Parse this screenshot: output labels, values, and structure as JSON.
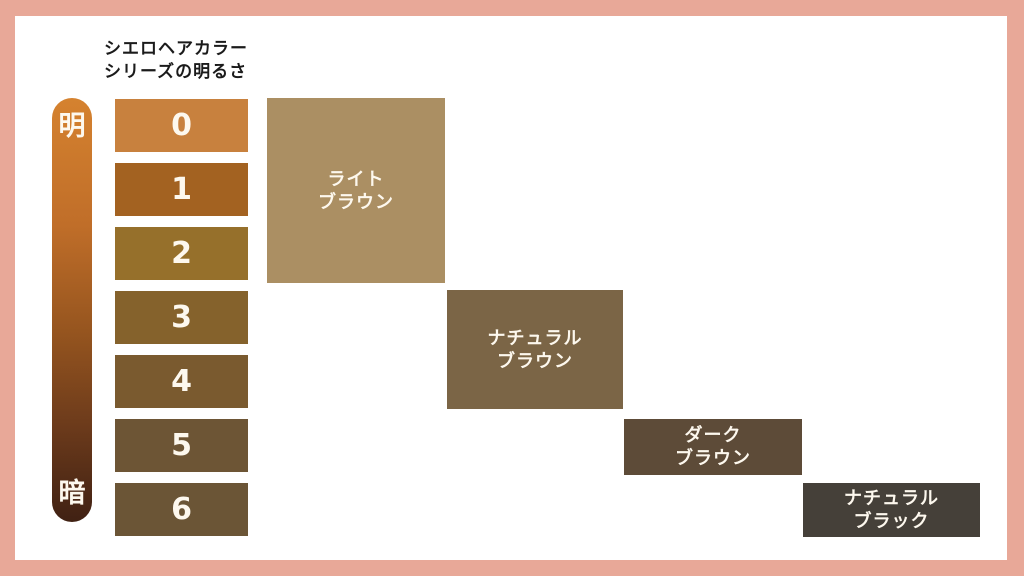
{
  "page": {
    "frame_color": "#e8a898",
    "canvas_color": "#ffffff"
  },
  "title": {
    "line1": "シエロヘアカラー",
    "line2": "シリーズの明るさ"
  },
  "brightness_bar": {
    "bright_label": "明",
    "dark_label": "暗",
    "gradient_stops": [
      "#d5822f 0%",
      "#c06e29 30%",
      "#96551f 55%",
      "#6b3a1b 78%",
      "#402113 100%"
    ]
  },
  "levels": [
    {
      "value": "0",
      "color": "#c8813e"
    },
    {
      "value": "1",
      "color": "#a36221"
    },
    {
      "value": "2",
      "color": "#96702b"
    },
    {
      "value": "3",
      "color": "#85622c"
    },
    {
      "value": "4",
      "color": "#7a5a2f"
    },
    {
      "value": "5",
      "color": "#6d5535"
    },
    {
      "value": "6",
      "color": "#6b5536"
    }
  ],
  "categories": [
    {
      "line1": "ライト",
      "line2": "ブラウン",
      "color": "#ab8f63"
    },
    {
      "line1": "ナチュラル",
      "line2": "ブラウン",
      "color": "#7b6546"
    },
    {
      "line1": "ダーク",
      "line2": "ブラウン",
      "color": "#5d4b38"
    },
    {
      "line1": "ナチュラル",
      "line2": "ブラック",
      "color": "#454039"
    }
  ]
}
